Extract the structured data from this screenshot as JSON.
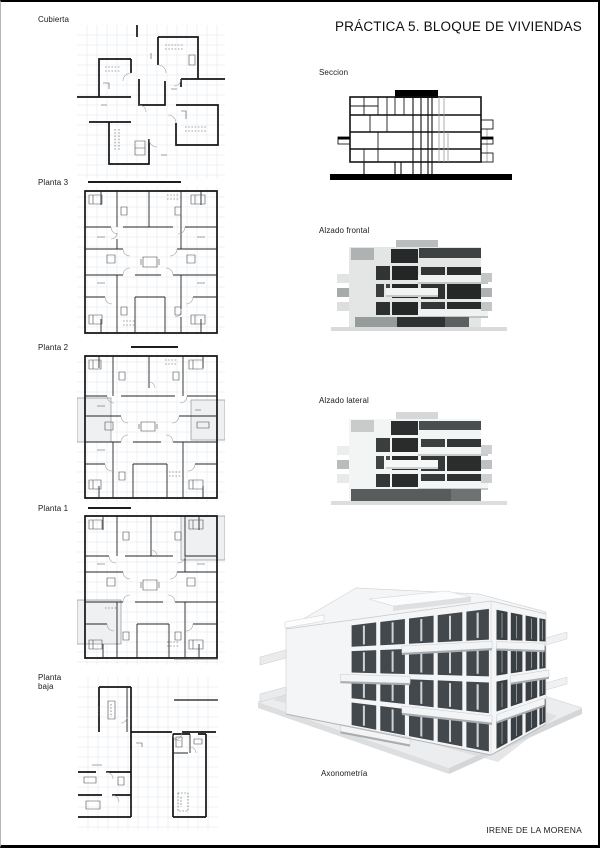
{
  "page": {
    "title": "PRÁCTICA 5. BLOQUE DE VIVIENDAS",
    "author": "IRENE DE LA MORENA"
  },
  "plans": [
    {
      "label": "Cubierta"
    },
    {
      "label": "Planta 3"
    },
    {
      "label": "Planta 2"
    },
    {
      "label": "Planta 1"
    },
    {
      "label": "Planta baja"
    }
  ],
  "views": {
    "section_label": "Seccion",
    "front_elevation_label": "Alzado frontal",
    "side_elevation_label": "Alzado lateral",
    "axonometry_label": "Axonometría"
  },
  "colors": {
    "ink": "#141414",
    "grid": "#e0e6ec",
    "facade_light": "#e4e6e6",
    "window_dark": "#2a2c2c",
    "model_white": "#f4f5f6",
    "plate_gray": "#ecedee"
  }
}
